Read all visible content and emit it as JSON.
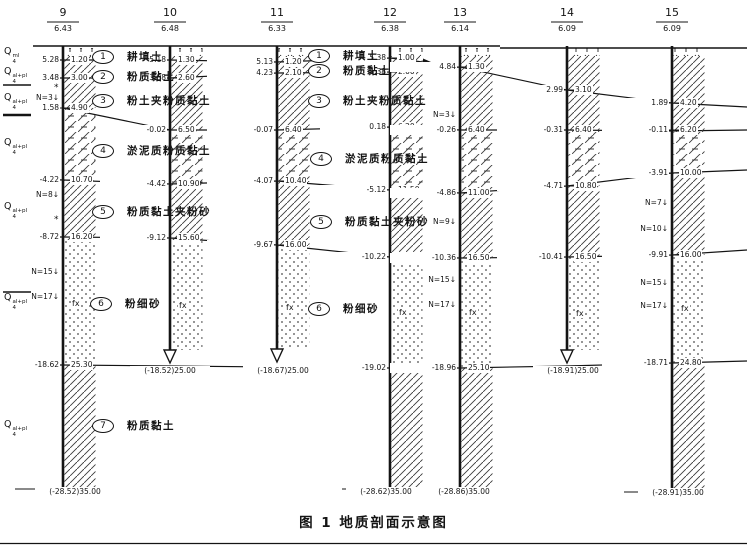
{
  "caption": "图 1  地质剖面示意图",
  "fx_text": "fx",
  "asterisk": "*",
  "colors": {
    "ink": "#141414",
    "paper": "#ffffff"
  },
  "boreholes": [
    {
      "no": "9",
      "elev": "6.43",
      "x": 63,
      "end_y": 487,
      "terminated": false,
      "bands": {
        "mud_top": 108,
        "mud_bot": 180,
        "sand_top": 240,
        "sand_bot": 365
      },
      "pairs": [
        {
          "left": "5.28",
          "right": "1.20",
          "y": 60
        },
        {
          "left": "3.48",
          "right": "3.00",
          "y": 78
        },
        {
          "left": "1.58",
          "right": "4.90",
          "y": 108
        },
        {
          "left": "-4.22",
          "right": "10.70",
          "y": 180
        },
        {
          "left": "-8.72",
          "right": "16.20",
          "y": 237
        },
        {
          "left": "-18.62",
          "right": "25.30",
          "y": 365
        }
      ],
      "n_values": [
        {
          "t": "N=3↓",
          "y": 98
        },
        {
          "t": "N=8↓",
          "y": 195
        },
        {
          "t": "N=15↓",
          "y": 272
        },
        {
          "t": "N=17↓",
          "y": 297
        }
      ],
      "fx_y": 303,
      "bottom_label": {
        "t": "(-28.52)35.00",
        "cx": 75,
        "y": 492
      }
    },
    {
      "no": "10",
      "elev": "6.48",
      "x": 170,
      "end_y": 350,
      "terminated": true,
      "bands": {
        "mud_top": 130,
        "mud_bot": 184,
        "sand_top": 240,
        "sand_bot": 350
      },
      "pairs": [
        {
          "left": "5.18",
          "right": "1.30",
          "y": 60
        },
        {
          "left": "3.88",
          "right": "2.60",
          "y": 78
        },
        {
          "left": "-0.02",
          "right": "6.50",
          "y": 130
        },
        {
          "left": "-4.42",
          "right": "10.90",
          "y": 184
        },
        {
          "left": "-9.12",
          "right": "15.60",
          "y": 238
        }
      ],
      "n_values": [],
      "fx_y": 305,
      "bottom_label": {
        "t": "(-18.52)25.00",
        "cx": 170,
        "y": 371
      }
    },
    {
      "no": "11",
      "elev": "6.33",
      "x": 277,
      "end_y": 349,
      "terminated": true,
      "bands": {
        "mud_top": 130,
        "mud_bot": 181,
        "sand_top": 246,
        "sand_bot": 349
      },
      "pairs": [
        {
          "left": "5.13",
          "right": "1.20",
          "y": 62
        },
        {
          "left": "4.23",
          "right": "2.10",
          "y": 73
        },
        {
          "left": "-0.07",
          "right": "6.40",
          "y": 130
        },
        {
          "left": "-4.07",
          "right": "10.40",
          "y": 181
        },
        {
          "left": "-9.67",
          "right": "16.00",
          "y": 245
        }
      ],
      "n_values": [],
      "fx_y": 307,
      "bottom_label": {
        "t": "(-18.67)25.00",
        "cx": 283,
        "y": 371
      }
    },
    {
      "no": "12",
      "elev": "6.38",
      "x": 390,
      "end_y": 487,
      "terminated": false,
      "bands": {
        "mud_top": 127,
        "mud_bot": 190,
        "sand_top": 258,
        "sand_bot": 368
      },
      "pairs": [
        {
          "left": "5.38",
          "right": "1.00",
          "y": 58
        },
        {
          "left": "4.38",
          "right": "2.00",
          "y": 72
        },
        {
          "left": "0.18",
          "right": "6.20",
          "y": 127
        },
        {
          "left": "-5.12",
          "right": "11.50",
          "y": 190
        },
        {
          "left": "-10.22",
          "right": "16.60",
          "y": 257
        },
        {
          "left": "-19.02",
          "right": "25.40",
          "y": 368
        }
      ],
      "n_values": [],
      "fx_y": 312,
      "bottom_label": {
        "t": "(-28.62)35.00",
        "cx": 386,
        "y": 492
      }
    },
    {
      "no": "13",
      "elev": "6.14",
      "x": 460,
      "end_y": 487,
      "terminated": false,
      "bands": {
        "mud_top": 130,
        "mud_bot": 193,
        "sand_top": 258,
        "sand_bot": 368
      },
      "pairs": [
        {
          "left": "4.84",
          "right": "1.30",
          "y": 67
        },
        {
          "left": "-0.26",
          "right": "6.40",
          "y": 130
        },
        {
          "left": "-4.86",
          "right": "11.00",
          "y": 193
        },
        {
          "left": "-10.36",
          "right": "16.50",
          "y": 258
        },
        {
          "left": "-18.96",
          "right": "25.10",
          "y": 368
        }
      ],
      "n_values": [
        {
          "t": "N=3↓",
          "y": 115
        },
        {
          "t": "N=9↓",
          "y": 222
        },
        {
          "t": "N=15↓",
          "y": 280
        },
        {
          "t": "N=17↓",
          "y": 305
        }
      ],
      "fx_y": 312,
      "bottom_label": {
        "t": "(-28.86)35.00",
        "cx": 464,
        "y": 492
      }
    },
    {
      "no": "14",
      "elev": "6.09",
      "x": 567,
      "end_y": 350,
      "terminated": true,
      "bands": {
        "mud_top": 130,
        "mud_bot": 186,
        "sand_top": 257,
        "sand_bot": 350
      },
      "pairs": [
        {
          "left": "2.99",
          "right": "3.10",
          "y": 90
        },
        {
          "left": "-0.31",
          "right": "6.40",
          "y": 130
        },
        {
          "left": "-4.71",
          "right": "10.80",
          "y": 186
        },
        {
          "left": "-10.41",
          "right": "16.50",
          "y": 257
        }
      ],
      "n_values": [],
      "fx_y": 313,
      "bottom_label": {
        "t": "(-18.91)25.00",
        "cx": 573,
        "y": 371
      }
    },
    {
      "no": "15",
      "elev": "6.09",
      "x": 672,
      "end_y": 490,
      "terminated": false,
      "bands": {
        "mud_top": 131,
        "mud_bot": 173,
        "sand_top": 255,
        "sand_bot": 363
      },
      "pairs": [
        {
          "left": "1.89",
          "right": "4.20",
          "y": 103
        },
        {
          "left": "-0.11",
          "right": "6.20",
          "y": 130
        },
        {
          "left": "-3.91",
          "right": "10.00",
          "y": 173
        },
        {
          "left": "-9.91",
          "right": "16.00",
          "y": 255
        },
        {
          "left": "-18.71",
          "right": "24.80",
          "y": 363
        }
      ],
      "n_values": [
        {
          "t": "N=7↓",
          "y": 203
        },
        {
          "t": "N=10↓",
          "y": 229
        },
        {
          "t": "N=15↓",
          "y": 283
        },
        {
          "t": "N=17↓",
          "y": 306
        }
      ],
      "fx_y": 308,
      "bottom_label": {
        "t": "(-28.91)35.00",
        "cx": 678,
        "y": 493
      }
    }
  ],
  "strata_left": [
    {
      "base": "Q",
      "sub": "4",
      "sup": "ml",
      "y": 52
    },
    {
      "base": "Q",
      "sub": "4",
      "sup": "al+pl",
      "y": 72
    },
    {
      "base": "Q",
      "sub": "4",
      "sup": "al+pl",
      "y": 98
    },
    {
      "base": "Q",
      "sub": "4",
      "sup": "al+pl",
      "y": 143
    },
    {
      "base": "Q",
      "sub": "4",
      "sup": "al+pl",
      "y": 207
    },
    {
      "base": "Q",
      "sub": "4",
      "sup": "al+pl",
      "y": 298
    },
    {
      "base": "Q",
      "sub": "4",
      "sup": "al+pl",
      "y": 425
    }
  ],
  "margin_dividers": [
    {
      "y": 63,
      "w": 1.5
    },
    {
      "y": 85,
      "w": 1.5
    },
    {
      "y": 115,
      "w": 2.5
    },
    {
      "y": 292,
      "w": 1.5
    }
  ],
  "asterisks": [
    {
      "x": 54,
      "y": 84
    },
    {
      "x": 54,
      "y": 216
    }
  ],
  "layer_annotations": [
    {
      "num": "1",
      "name": "耕填土",
      "cx": 102,
      "y": 56
    },
    {
      "num": "2",
      "name": "粉质黏土",
      "cx": 102,
      "y": 76
    },
    {
      "num": "3",
      "name": "粉土夹粉质黏土",
      "cx": 102,
      "y": 100
    },
    {
      "num": "4",
      "name": "淤泥质粉质黏土",
      "cx": 102,
      "y": 150
    },
    {
      "num": "5",
      "name": "粉质黏土夹粉砂",
      "cx": 102,
      "y": 211
    },
    {
      "num": "6",
      "name": "粉细砂",
      "cx": 100,
      "y": 303
    },
    {
      "num": "7",
      "name": "粉质黏土",
      "cx": 102,
      "y": 425
    },
    {
      "num": "1",
      "name": "耕填土",
      "cx": 318,
      "y": 55
    },
    {
      "num": "2",
      "name": "粉质黏土",
      "cx": 318,
      "y": 70
    },
    {
      "num": "3",
      "name": "粉土夹粉质黏土",
      "cx": 318,
      "y": 100
    },
    {
      "num": "4",
      "name": "淤泥质粉质黏土",
      "cx": 320,
      "y": 158
    },
    {
      "num": "5",
      "name": "粉质黏土夹粉砂",
      "cx": 320,
      "y": 221
    },
    {
      "num": "6",
      "name": "粉细砂",
      "cx": 318,
      "y": 308
    }
  ],
  "boundary_lines": [
    {
      "name": "layer1-bottom",
      "arrow_end": true,
      "points": [
        [
          34,
          60
        ],
        [
          63,
          60
        ],
        [
          170,
          60
        ],
        [
          277,
          62
        ],
        [
          390,
          58
        ],
        [
          423,
          62
        ]
      ]
    },
    {
      "name": "layer2-bottom",
      "arrow_end": false,
      "points": [
        [
          34,
          78
        ],
        [
          63,
          78
        ],
        [
          170,
          78
        ],
        [
          277,
          73
        ],
        [
          390,
          72
        ],
        [
          460,
          67
        ],
        [
          567,
          90
        ],
        [
          672,
          103
        ],
        [
          747,
          107
        ]
      ]
    },
    {
      "name": "layer3-bottom",
      "arrow_end": false,
      "points": [
        [
          63,
          108
        ],
        [
          170,
          130
        ],
        [
          277,
          130
        ],
        [
          390,
          127
        ],
        [
          460,
          130
        ],
        [
          567,
          130
        ],
        [
          672,
          131
        ],
        [
          747,
          130
        ]
      ]
    },
    {
      "name": "layer4-bottom",
      "arrow_end": false,
      "points": [
        [
          0,
          178
        ],
        [
          63,
          180
        ],
        [
          170,
          184
        ],
        [
          277,
          181
        ],
        [
          390,
          190
        ],
        [
          460,
          193
        ],
        [
          567,
          186
        ],
        [
          672,
          173
        ],
        [
          747,
          170
        ]
      ]
    },
    {
      "name": "layer5-bottom",
      "arrow_end": false,
      "points": [
        [
          0,
          237
        ],
        [
          63,
          237
        ],
        [
          170,
          238
        ],
        [
          277,
          245
        ],
        [
          390,
          257
        ],
        [
          460,
          258
        ],
        [
          567,
          257
        ],
        [
          672,
          255
        ],
        [
          747,
          250
        ]
      ]
    },
    {
      "name": "layer6-bottom",
      "arrow_end": false,
      "points": [
        [
          0,
          365
        ],
        [
          63,
          365
        ],
        [
          170,
          366
        ],
        [
          277,
          367
        ],
        [
          390,
          368
        ],
        [
          460,
          368
        ],
        [
          567,
          366
        ],
        [
          672,
          363
        ],
        [
          747,
          361
        ]
      ]
    }
  ],
  "ground": {
    "segments": [
      [
        33,
        46,
        500,
        46
      ],
      [
        500,
        48,
        747,
        48
      ]
    ]
  },
  "page_rule_y": 543.5
}
